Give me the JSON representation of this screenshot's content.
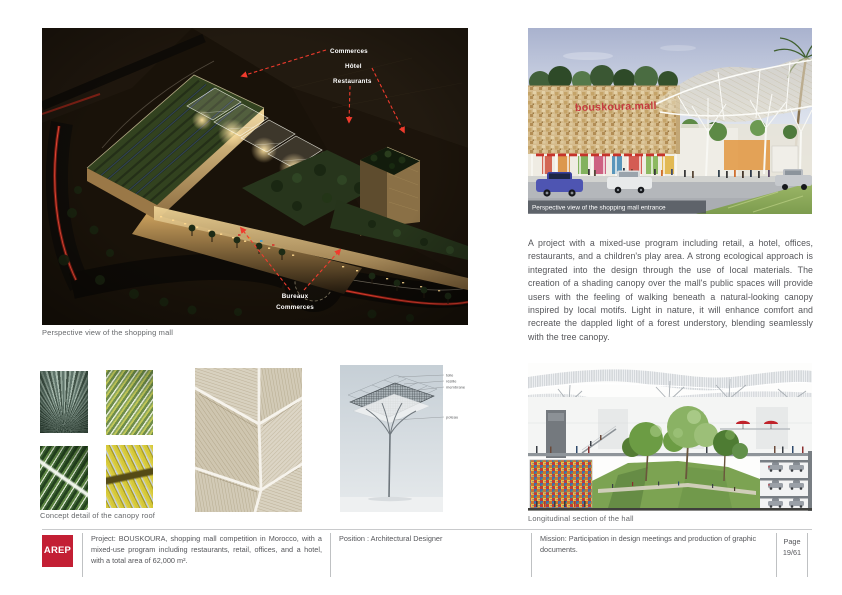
{
  "colors": {
    "annotation_red": "#ef3b2d",
    "sign_red": "#c63b40",
    "logo_red": "#c31f34",
    "caption_gray": "#66686b",
    "body_text": "#55565a"
  },
  "main_view": {
    "caption": "Perspective view of the shopping mall",
    "annotations_top": [
      "Commerces",
      "Hôtel",
      "Restaurants"
    ],
    "annotations_bottom": [
      "Bureaux",
      "Commerces"
    ]
  },
  "entrance_view": {
    "caption": "Perspective view of the shopping mall entrance",
    "building_sign": "bouskoura.mall"
  },
  "description": "A project with a mixed-use program including retail, a hotel, offices, restaurants, and a children's play area. A strong ecological approach is integrated into the design through the use of local materials. The creation of a shading canopy over the mall's public spaces will provide users with the feeling of walking beneath a natural-looking canopy inspired by local motifs. Light in nature, it will enhance comfort and recreate the dappled light of a forest understory, blending seamlessly with the tree canopy.",
  "concept_detail": {
    "caption": "Concept detail of the canopy roof",
    "diagram_labels": [
      "toile",
      "résille",
      "membrane",
      "poteau"
    ]
  },
  "section_view": {
    "caption": "Longitudinal section of the hall"
  },
  "footer": {
    "logo": "AREP",
    "project": "Project: BOUSKOURA, shopping mall competition in Morocco, with a mixed-use program including restaurants, retail, offices, and a hotel, with a total area of 62,000 m².",
    "position": "Position : Architectural Designer",
    "mission": "Mission: Participation in design meetings and production of graphic documents.",
    "page_label": "Page",
    "page_number": "19/61"
  }
}
